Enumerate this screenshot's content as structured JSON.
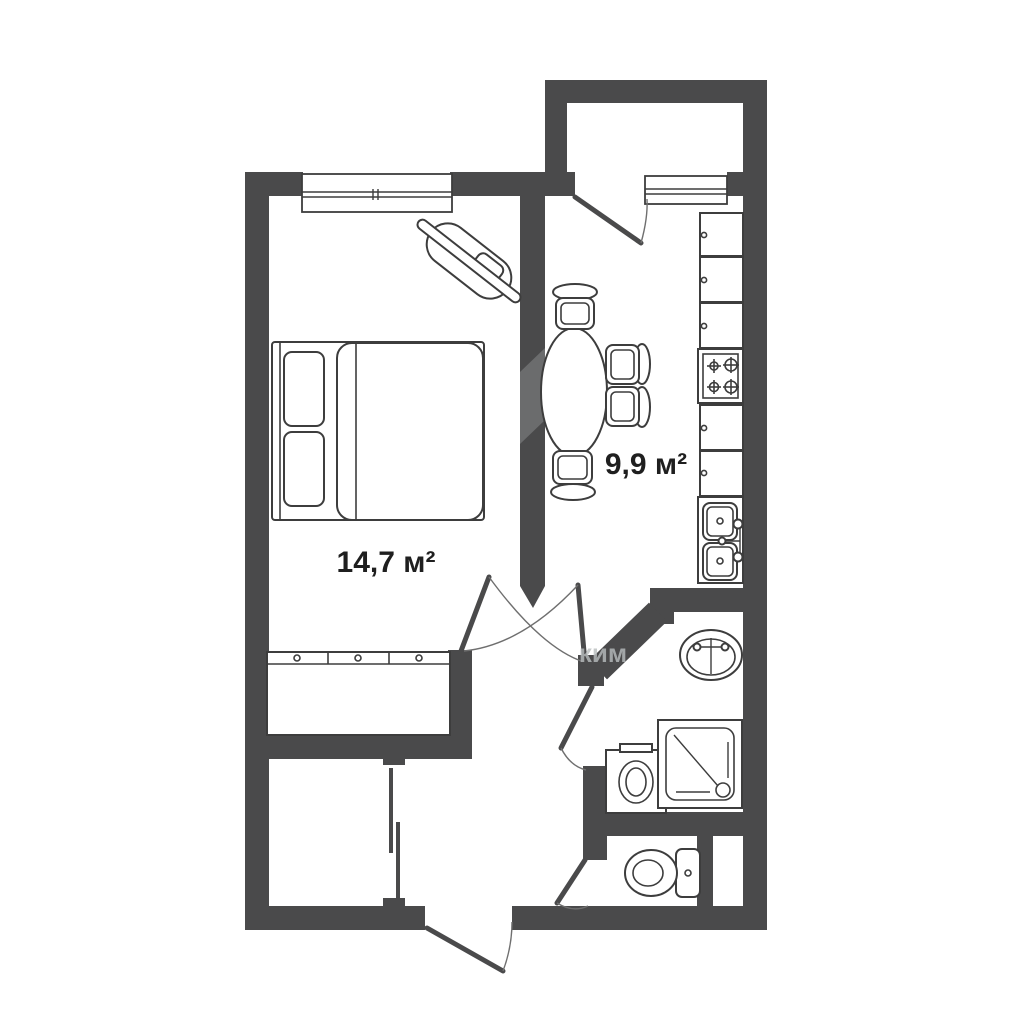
{
  "plan": {
    "rooms": {
      "bedroom": {
        "name": "bedroom",
        "area_label": "14,7 м²"
      },
      "kitchen": {
        "name": "kitchen",
        "area_label": "9,9 м²"
      }
    },
    "watermark_fragment": "ким",
    "colors": {
      "wall": "#4a4a4b",
      "line": "#3d3d3d",
      "arc": "#6f6f6f",
      "text": "#1f1f1f",
      "background": "#ffffff",
      "watermark": "#b9bdbe"
    },
    "furniture": {
      "bedroom": [
        "double-bed",
        "wardrobe",
        "corner-tv-stand"
      ],
      "kitchen": [
        "dining-table",
        "chair",
        "kitchen-cabinets",
        "stove-4-burner",
        "double-sink"
      ],
      "bathroom": [
        "washbasin",
        "washing-machine",
        "shower-cabin"
      ],
      "wc": [
        "toilet"
      ]
    },
    "openings": [
      "bedroom-window",
      "balcony-window",
      "balcony-door",
      "bedroom-door",
      "kitchen-door",
      "bathroom-door",
      "wc-door",
      "closet-sliding-door",
      "entrance-door"
    ]
  }
}
